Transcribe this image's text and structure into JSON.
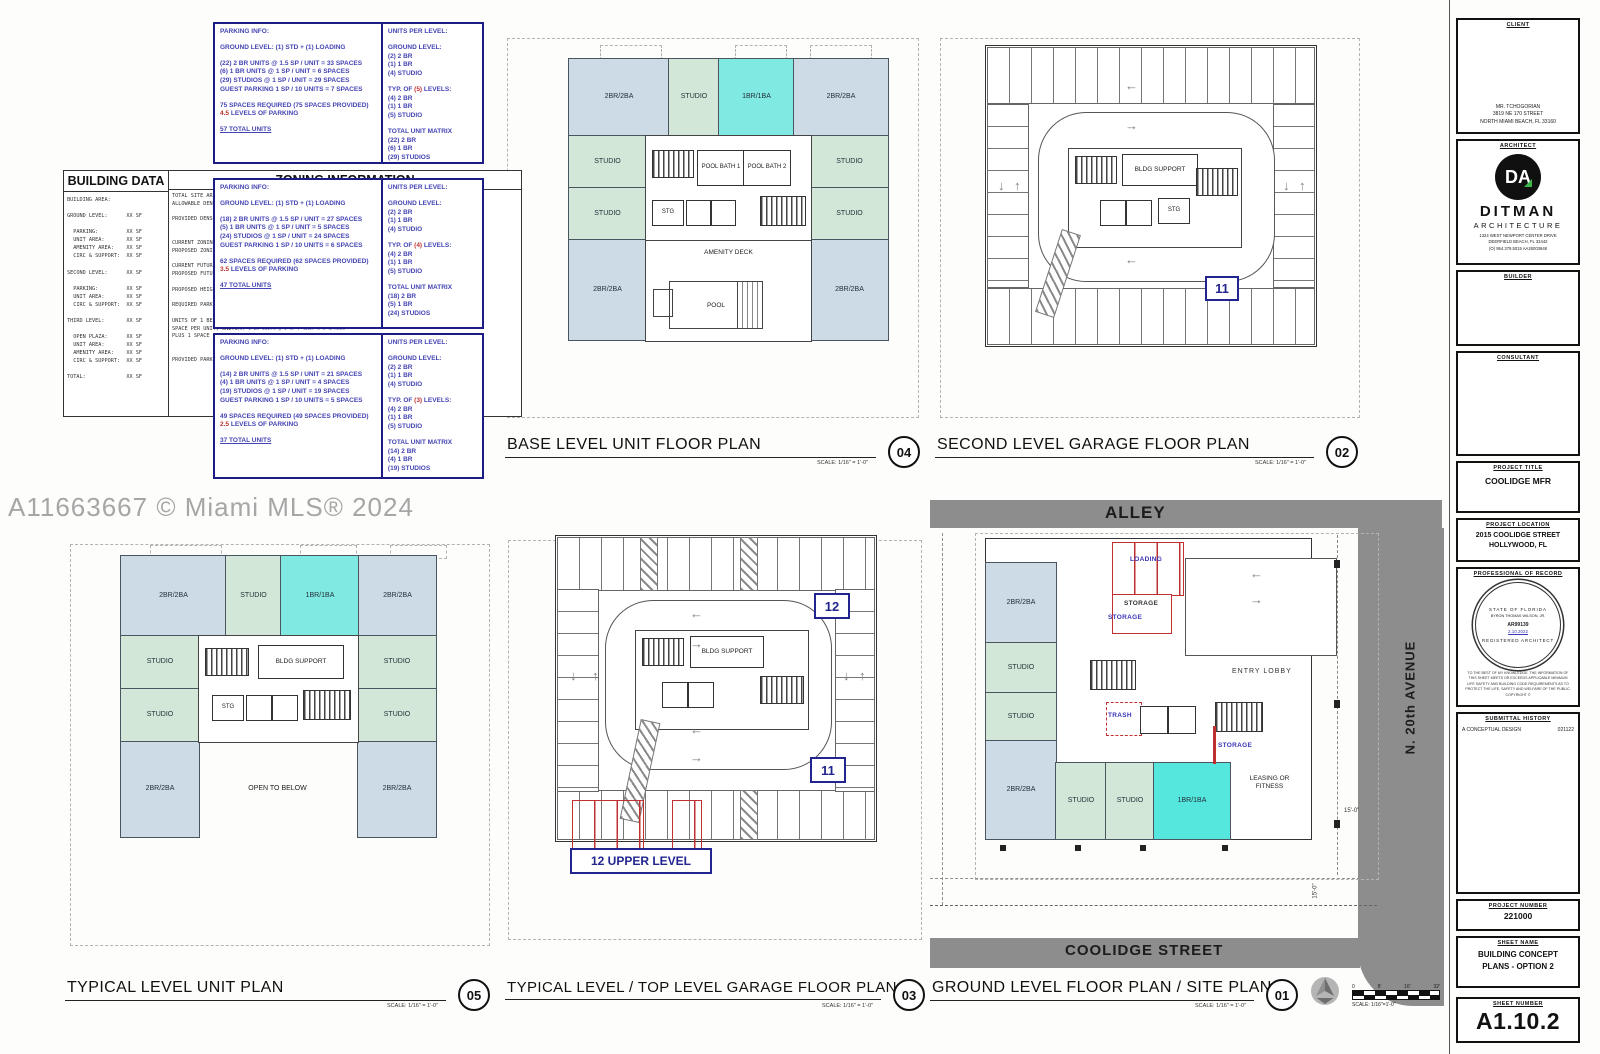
{
  "watermark": "A11663667 © Miami MLS® 2024",
  "scale_note": "SCALE: 1/16\" = 1'-0\"",
  "scale_bar": {
    "ticks": [
      "0",
      "8'",
      "16'",
      "32'"
    ],
    "note": "SCALE: 1/16\"=1'-0\""
  },
  "icons": {
    "arrow_left": "←",
    "arrow_right": "→",
    "arrow_up": "↑",
    "arrow_down": "↓"
  },
  "labels": {
    "two_br": "2BR/2BA",
    "studio": "STUDIO",
    "one_br": "1BR/1BA",
    "pool_bath_1": "POOL BATH 1",
    "pool_bath_2": "POOL BATH 2",
    "stg": "STG",
    "amenity_deck": "AMENITY DECK",
    "pool": "POOL",
    "bldg_support": "BLDG SUPPORT",
    "open_to_below": "OPEN TO BELOW",
    "entry_lobby": "ENTRY LOBBY",
    "leasing_or_fitness": "LEASING OR FITNESS",
    "loading": "LOADING",
    "storage": "STORAGE",
    "trash": "TRASH",
    "alley": "ALLEY",
    "coolidge_street": "COOLIDGE STREET",
    "n_20th_avenue": "N. 20th AVENUE",
    "upper_level": "12 UPPER LEVEL",
    "level_11": "11",
    "level_12": "12",
    "dim_15": "15'-0\""
  },
  "building_data": {
    "title": "BUILDING DATA",
    "lines": [
      "BUILDING AREA:",
      "",
      "GROUND LEVEL:      XX SF",
      "",
      "  PARKING:         XX SF",
      "  UNIT AREA:       XX SF",
      "  AMENITY AREA:    XX SF",
      "  CIRC & SUPPORT:  XX SF",
      "",
      "SECOND LEVEL:      XX SF",
      "",
      "  PARKING:         XX SF",
      "  UNIT AREA:       XX SF",
      "  CIRC & SUPPORT:  XX SF",
      "",
      "THIRD LEVEL:       XX SF",
      "",
      "  OPEN PLAZA:      XX SF",
      "  UNIT AREA:       XX SF",
      "  AMENITY AREA:    XX SF",
      "  CIRC & SUPPORT:  XX SF",
      "",
      "TOTAL:             XX SF"
    ]
  },
  "zoning": {
    "title": "ZONING INFORMATION",
    "lines": [
      "TOTAL SITE AREA:",
      "ALLOWABLE DENSITY:",
      "",
      "PROVIDED DENSITY:",
      "",
      "",
      "CURRENT ZONING DIST:",
      "PROPOSED ZONING:",
      "",
      "CURRENT FUTURE LAND:",
      "PROPOSED FUTURE LAND:",
      "",
      "PROPOSED HEIGHT:",
      "",
      "REQUIRED PARKING:",
      "",
      "UNITS OF 1 BEDROOM",
      "SPACE PER UNIT, UNITS",
      "PLUS 1 SPACE PER 10",
      "",
      "",
      "PROVIDED PARKING:"
    ],
    "sliver": [
      "(23) 2 BR UNITS @ 1.5 SP / UNIT = 23 SPACES",
      "(5) 1 BR UNITS @ 1 SP / UNIT = 5 SPACES"
    ]
  },
  "parking_boxes": [
    {
      "header": "PARKING INFO:",
      "ground": "GROUND LEVEL: (1) STD + (1) LOADING",
      "calc": [
        "(22) 2 BR UNITS @ 1.5 SP / UNIT = 33 SPACES",
        "(6) 1 BR UNITS @ 1 SP / UNIT = 6 SPACES",
        "(29) STUDIOS @ 1 SP / UNIT = 29 SPACES",
        "GUEST PARKING 1 SP / 10 UNITS = 7 SPACES"
      ],
      "required": "75 SPACES REQUIRED (75 SPACES PROVIDED)",
      "levels_num": "4.5",
      "levels_rest": " LEVELS OF PARKING",
      "total": "57 TOTAL UNITS",
      "units_header": "UNITS PER LEVEL:",
      "units_ground_title": "GROUND LEVEL:",
      "units_ground": [
        "(2) 2 BR",
        "(1) 1 BR",
        "(4) STUDIO"
      ],
      "typ_pre": "TYP. OF ",
      "typ_num": "(5)",
      "typ_post": " LEVELS:",
      "units_typ": [
        "(4) 2 BR",
        "(1) 1 BR",
        "(5) STUDIO"
      ],
      "matrix_title": "TOTAL UNIT MATRIX",
      "matrix": [
        "(22) 2 BR",
        "(6) 1 BR",
        "(29) STUDIOS"
      ]
    },
    {
      "header": "PARKING INFO:",
      "ground": "GROUND LEVEL: (1) STD + (1) LOADING",
      "calc": [
        "(18) 2 BR UNITS @ 1.5 SP / UNIT = 27 SPACES",
        "(5) 1 BR UNITS @ 1 SP / UNIT = 5 SPACES",
        "(24) STUDIOS @ 1 SP / UNIT = 24 SPACES",
        "GUEST PARKING 1 SP / 10 UNITS = 6 SPACES"
      ],
      "required": "62 SPACES REQUIRED (62 SPACES PROVIDED)",
      "levels_num": "3.5",
      "levels_rest": " LEVELS OF PARKING",
      "total": "47 TOTAL UNITS",
      "units_header": "UNITS PER LEVEL:",
      "units_ground_title": "GROUND LEVEL:",
      "units_ground": [
        "(2) 2 BR",
        "(1) 1 BR",
        "(4) STUDIO"
      ],
      "typ_pre": "TYP. OF ",
      "typ_num": "(4)",
      "typ_post": " LEVELS:",
      "units_typ": [
        "(4) 2 BR",
        "(1) 1 BR",
        "(5) STUDIO"
      ],
      "matrix_title": "TOTAL UNIT MATRIX",
      "matrix": [
        "(18) 2 BR",
        "(5) 1 BR",
        "(24) STUDIOS"
      ]
    },
    {
      "header": "PARKING INFO:",
      "ground": "GROUND LEVEL: (1) STD + (1) LOADING",
      "calc": [
        "(14) 2 BR UNITS @ 1.5 SP / UNIT = 21 SPACES",
        "(4) 1 BR UNITS @ 1 SP / UNIT = 4 SPACES",
        "(19) STUDIOS @ 1 SP / UNIT = 19 SPACES",
        "GUEST PARKING 1 SP / 10 UNITS = 5 SPACES"
      ],
      "required": "49 SPACES REQUIRED (49 SPACES PROVIDED)",
      "levels_num": "2.5",
      "levels_rest": " LEVELS OF PARKING",
      "total": "37 TOTAL UNITS",
      "units_header": "UNITS PER LEVEL:",
      "units_ground_title": "GROUND LEVEL:",
      "units_ground": [
        "(2) 2 BR",
        "(1) 1 BR",
        "(4) STUDIO"
      ],
      "typ_pre": "TYP. OF ",
      "typ_num": "(3)",
      "typ_post": " LEVELS:",
      "units_typ": [
        "(4) 2 BR",
        "(1) 1 BR",
        "(5) STUDIO"
      ],
      "matrix_title": "TOTAL UNIT MATRIX",
      "matrix": [
        "(14) 2 BR",
        "(4) 1 BR",
        "(19) STUDIOS"
      ]
    }
  ],
  "plans": {
    "base": {
      "title": "BASE LEVEL UNIT FLOOR PLAN",
      "number": "04"
    },
    "second_garage": {
      "title": "SECOND LEVEL GARAGE FLOOR PLAN",
      "number": "02"
    },
    "typical_unit": {
      "title": "TYPICAL LEVEL UNIT PLAN",
      "number": "05"
    },
    "typical_garage": {
      "title": "TYPICAL LEVEL / TOP LEVEL GARAGE FLOOR PLAN",
      "number": "03"
    },
    "ground": {
      "title": "GROUND LEVEL FLOOR PLAN / SITE PLAN",
      "number": "01"
    }
  },
  "titleblock": {
    "client_label": "CLIENT",
    "client": [
      "MR. TCHOGORIAN",
      "3819 NE 170 STREET",
      "NORTH MIAMI BEACH, FL 33160"
    ],
    "architect_label": "ARCHITECT",
    "logo_text": "DA",
    "architect_name": "DITMAN",
    "architect_sub": "ARCHITECTURE",
    "architect_addr": [
      "1324 WEST NEWPORT CENTER DRIVE",
      "DEERFIELD BEACH, FL 33442",
      "(O)  954.379.5015      AA26003648"
    ],
    "builder_label": "BUILDER",
    "consultant_label": "CONSULTANT",
    "project_title_label": "PROJECT TITLE",
    "project_title": "COOLIDGE MFR",
    "project_location_label": "PROJECT LOCATION",
    "project_location": [
      "2015 COOLIDGE STREET",
      "HOLLYWOOD, FL"
    ],
    "por_label": "PROFESSIONAL OF RECORD",
    "seal_top": "STATE OF FLORIDA",
    "seal_name": "BYRON THOMAS WILSON, JR.",
    "seal_number": "AR99139",
    "seal_date": "2.10.2022",
    "seal_bottom": "REGISTERED ARCHITECT",
    "por_note": [
      "TO THE BEST OF MY KNOWLEDGE, THE INFORMATION OF",
      "THIS SHEET MEETS OR EXCEEDS APPLICABLE MINIMUM",
      "LIFE SAFETY AND BUILDING CODE REQUIREMENTS AS TO",
      "PROTECT THE LIFE, SAFETY AND WELFARE OF THE PUBLIC.",
      "COPYRIGHT ©"
    ],
    "submittal_label": "SUBMITTAL HISTORY",
    "submittal_entry": "A  CONCEPTUAL DESIGN",
    "submittal_date": "021122",
    "project_number_label": "PROJECT NUMBER",
    "project_number": "221000",
    "sheet_name_label": "SHEET NAME",
    "sheet_name": [
      "BUILDING CONCEPT",
      "PLANS - OPTION 2"
    ],
    "sheet_number_label": "SHEET NUMBER",
    "sheet_number": "A1.10.2"
  }
}
